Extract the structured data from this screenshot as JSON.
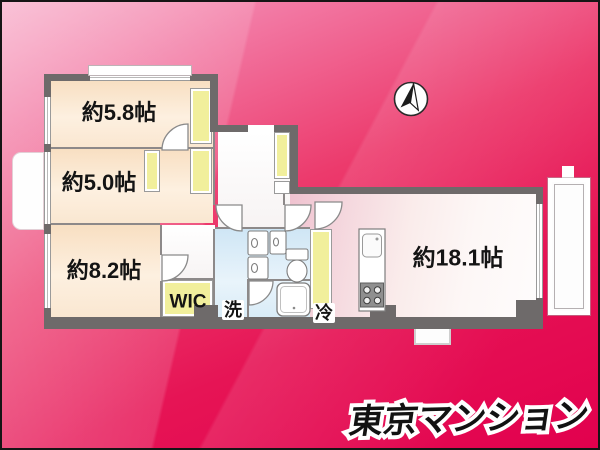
{
  "branding": {
    "logo_text": "東京マンション"
  },
  "rooms": [
    {
      "id": "bedroom-5-8",
      "label": "約5.8帖"
    },
    {
      "id": "bedroom-5-0",
      "label": "約5.0帖"
    },
    {
      "id": "bedroom-8-2",
      "label": "約8.2帖"
    },
    {
      "id": "walk-in-closet",
      "label": "WIC"
    },
    {
      "id": "laundry",
      "label": "洗"
    },
    {
      "id": "refrigerator-space",
      "label": "冷"
    },
    {
      "id": "living-dining",
      "label": "約18.1帖"
    }
  ],
  "icons": {
    "compass": "north-arrow"
  },
  "colors": {
    "background_top": "#f7a8c6",
    "background_bottom": "#e2004e",
    "wall": "#6e6a6a",
    "room_cream": "#fbe9d4",
    "closet_yellow": "#f1ef9c",
    "wet_blue": "#d8ebf7",
    "kitchen_pink": "#efc0ce",
    "living_white": "#fdf7f6",
    "logo_fill": "#121212",
    "logo_outline": "#ffffff"
  }
}
